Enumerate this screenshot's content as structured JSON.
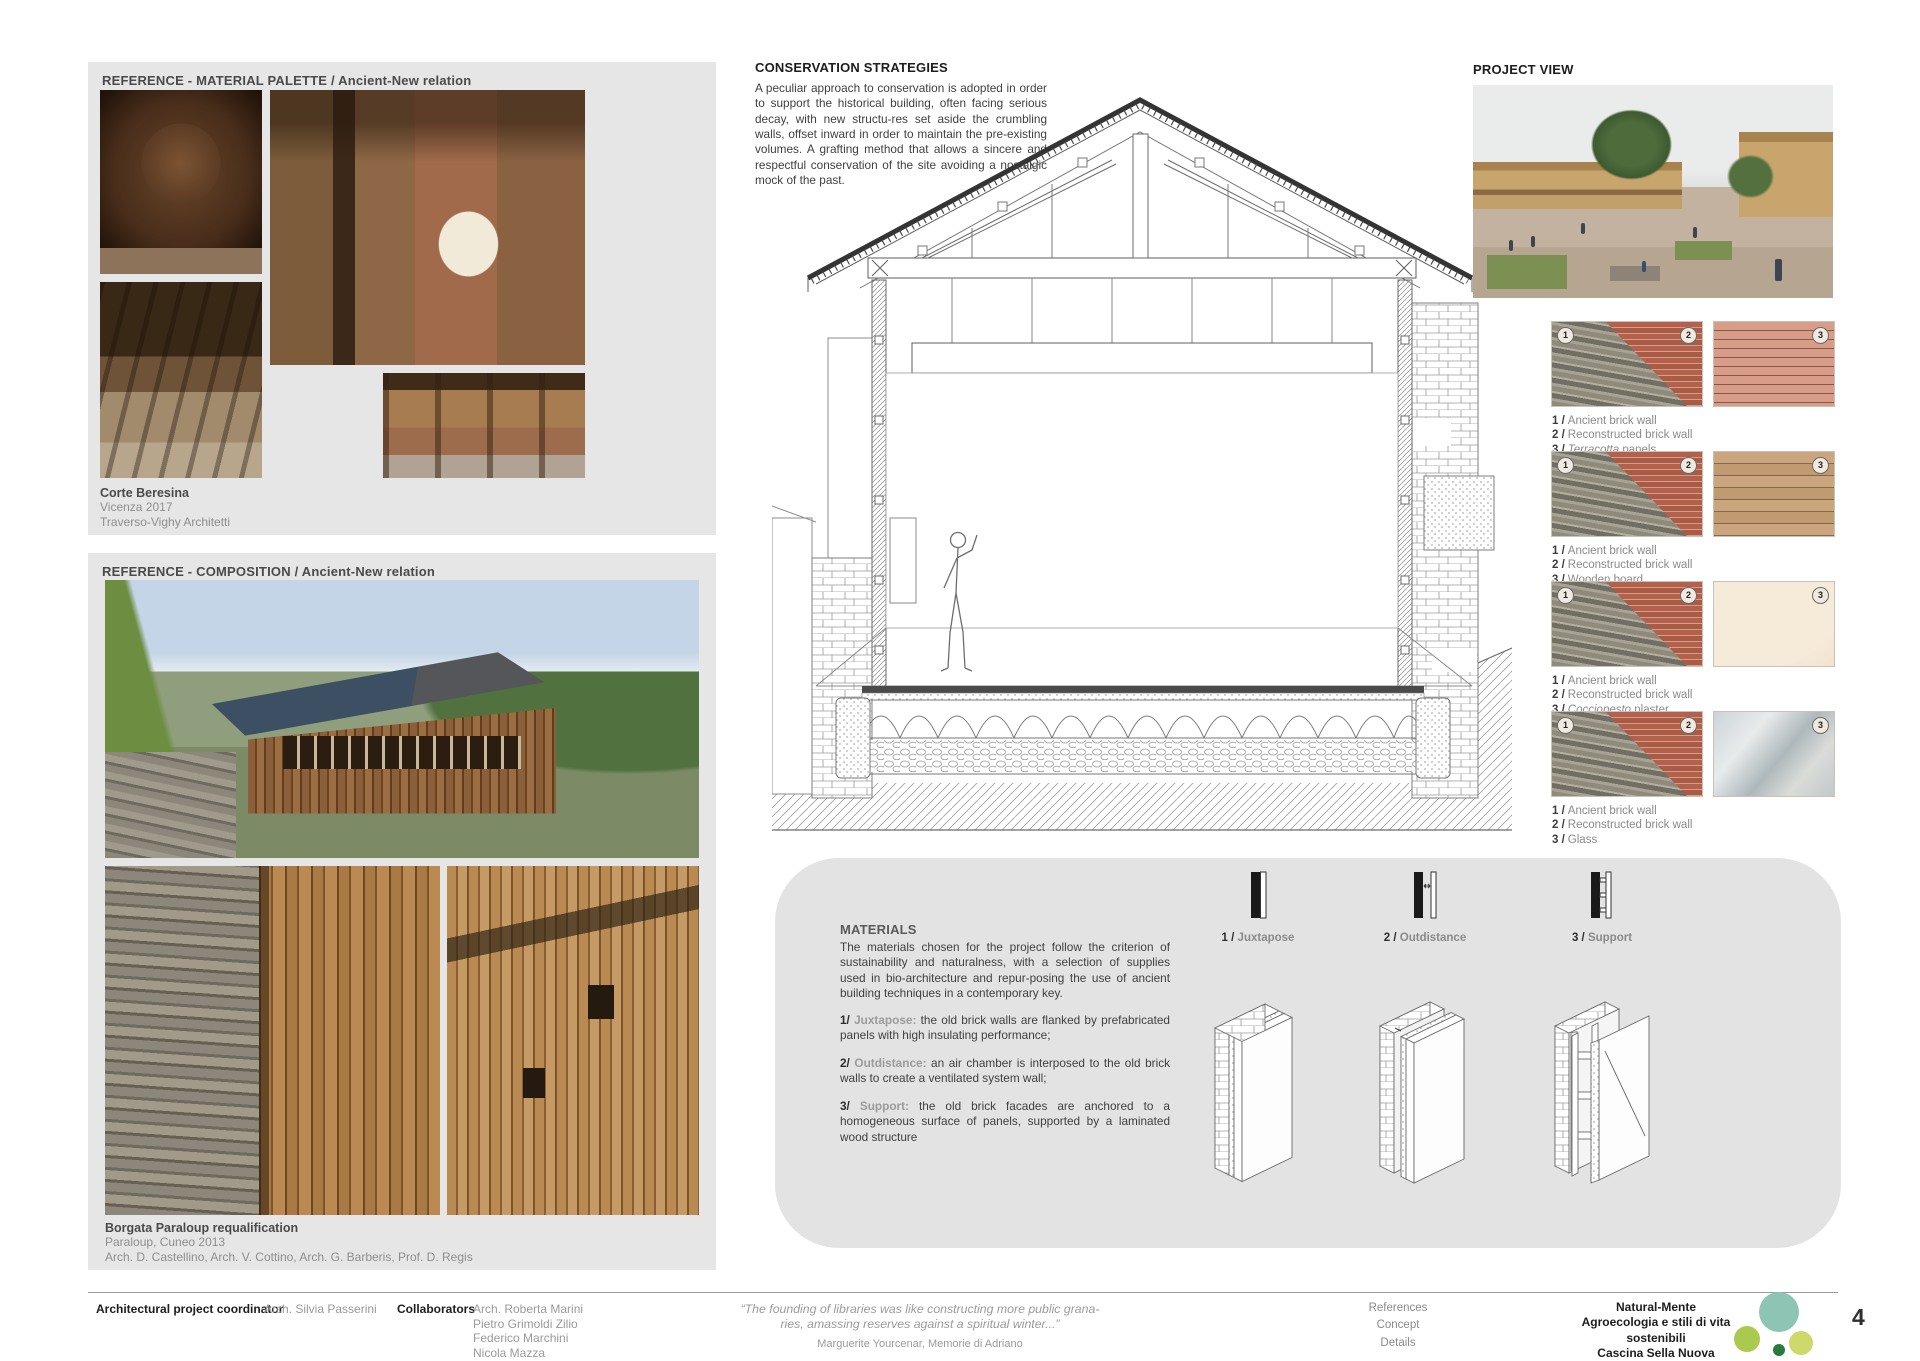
{
  "colors": {
    "panel_grey": "#e6e6e6",
    "materials_panel_grey": "#e3e3e3",
    "brick": "#b4604c",
    "logo_teal": "#8ec4b4",
    "logo_green_light": "#aac94e",
    "logo_green_pale": "#cdd96a",
    "logo_green_dark": "#2a7a3b"
  },
  "icons": {
    "juxtapose_plan": "juxtapose-plan-icon",
    "outdistance_plan": "outdistance-plan-icon",
    "support_plan": "support-plan-icon",
    "logo": "green-circles-logo"
  },
  "reference_material": {
    "title": "REFERENCE - MATERIAL PALETTE / Ancient-New relation",
    "caption_title": "Corte Beresina",
    "caption_line2": "Vicenza 2017",
    "caption_line3": "Traverso-Vighy Architetti"
  },
  "reference_composition": {
    "title": "REFERENCE - COMPOSITION / Ancient-New relation",
    "caption_title": "Borgata Paraloup requalification",
    "caption_line2": "Paraloup, Cuneo 2013",
    "caption_line3": "Arch. D. Castellino, Arch. V. Cottino, Arch. G. Barberis, Prof. D. Regis"
  },
  "conservation": {
    "title": "CONSERVATION STRATEGIES",
    "body": "A peculiar approach to conservation is adopted in order to support the historical building, often facing serious decay, with new structu-res set aside the crumbling walls, offset inward in order to maintain the pre-existing volumes. A grafting method that allows a sincere and respectful conservation of the site avoiding a nostalgic mock of the past."
  },
  "project_view": {
    "title": "PROJECT VIEW"
  },
  "material_samples": {
    "groups": [
      {
        "badges": [
          "1",
          "2",
          "3"
        ],
        "lines": [
          {
            "num": "1 /",
            "em": "",
            "rest": "Ancient brick wall"
          },
          {
            "num": "2 /",
            "em": "",
            "rest": "Reconstructed brick wall"
          },
          {
            "num": "3 /",
            "em": "Terracotta",
            "rest": " panels"
          }
        ]
      },
      {
        "badges": [
          "1",
          "2",
          "3"
        ],
        "lines": [
          {
            "num": "1 /",
            "em": "",
            "rest": "Ancient brick wall"
          },
          {
            "num": "2 /",
            "em": "",
            "rest": "Reconstructed brick wall"
          },
          {
            "num": "3 /",
            "em": "",
            "rest": "Wooden board"
          }
        ]
      },
      {
        "badges": [
          "1",
          "2",
          "3"
        ],
        "lines": [
          {
            "num": "1 /",
            "em": "",
            "rest": "Ancient brick wall"
          },
          {
            "num": "2 /",
            "em": "",
            "rest": "Reconstructed brick wall"
          },
          {
            "num": "3 /",
            "em": "Cocciopesto",
            "rest": " plaster"
          }
        ]
      },
      {
        "badges": [
          "1",
          "2",
          "3"
        ],
        "lines": [
          {
            "num": "1 /",
            "em": "",
            "rest": "Ancient brick wall"
          },
          {
            "num": "2 /",
            "em": "",
            "rest": "Reconstructed brick wall"
          },
          {
            "num": "3 /",
            "em": "",
            "rest": "Glass"
          }
        ]
      }
    ]
  },
  "materials": {
    "title": "MATERIALS",
    "body": "The materials chosen for the project follow the criterion of sustainability and naturalness, with a selection of supplies used in bio-architecture and repur-posing the use of ancient building techniques in a contemporary key.",
    "items": [
      {
        "num": "1/",
        "keyword": "Juxtapose:",
        "text": " the old brick walls are flanked by prefabricated panels with high insulating performance;"
      },
      {
        "num": "2/",
        "keyword": "Outdistance:",
        "text": " an air chamber is interposed to the old brick walls to create a ventilated system wall;"
      },
      {
        "num": "3/",
        "keyword": "Support:",
        "text": " the old brick facades are anchored to a homogeneous surface of panels, supported by a laminated wood structure"
      }
    ],
    "diagrams": [
      {
        "num": "1 /",
        "label": "Juxtapose"
      },
      {
        "num": "2 /",
        "label": "Outdistance"
      },
      {
        "num": "3 /",
        "label": "Support"
      }
    ]
  },
  "footer": {
    "coordinator_label": "Architectural project coordinator",
    "coordinator_name": "Arch. Silvia Passerini",
    "collaborators_label": "Collaborators",
    "collaborators": [
      "Arch. Roberta Marini",
      "Pietro Grimoldi Zilio",
      "Federico Marchini",
      "Nicola Mazza"
    ],
    "quote_line1": "“The founding of libraries was like constructing more public grana-",
    "quote_line2": "ries, amassing reserves against a spiritual winter...”",
    "quote_attribution": "Marguerite Yourcenar, Memorie di Adriano",
    "nav": [
      "References",
      "Concept",
      "Details"
    ],
    "project_name": "Natural-Mente",
    "project_subtitle": "Agroecologia e stili di vita sostenibili",
    "project_location": "Cascina Sella Nuova",
    "page_number": "4"
  }
}
